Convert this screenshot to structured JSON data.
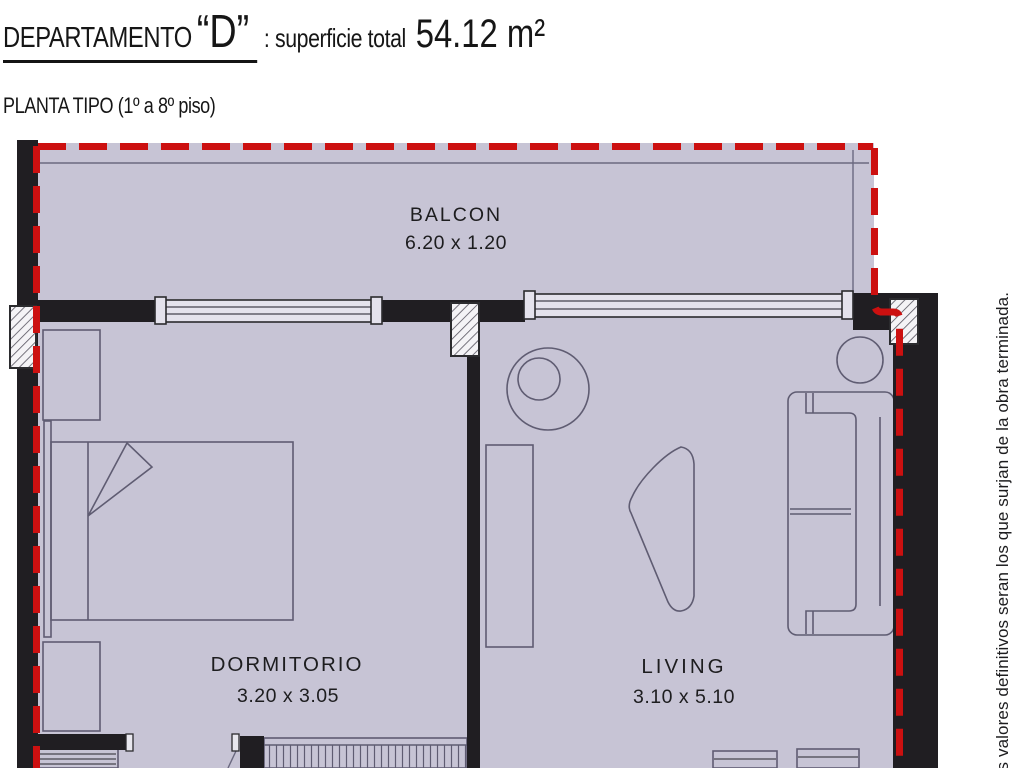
{
  "header": {
    "title_label": "DEPARTAMENTO",
    "unit_letter": "“D”",
    "subtitle": ": superficie total",
    "area_value": "54.12 m²",
    "plan_type": "PLANTA TIPO (1º a 8º piso)"
  },
  "plan": {
    "rooms": [
      {
        "name": "BALCON",
        "dimensions": "6.20 x 1.20"
      },
      {
        "name": "DORMITORIO",
        "dimensions": "3.20 x 3.05"
      },
      {
        "name": "LIVING",
        "dimensions": "3.10 x 5.10"
      }
    ],
    "side_note": "os valores definitivos seran los que surjan de la obra terminada.",
    "colors": {
      "floor_fill": "#c7c4d5",
      "wall_fill": "#201e22",
      "boundary_red": "#cc1010",
      "window_fill": "#e4e2ec"
    }
  }
}
